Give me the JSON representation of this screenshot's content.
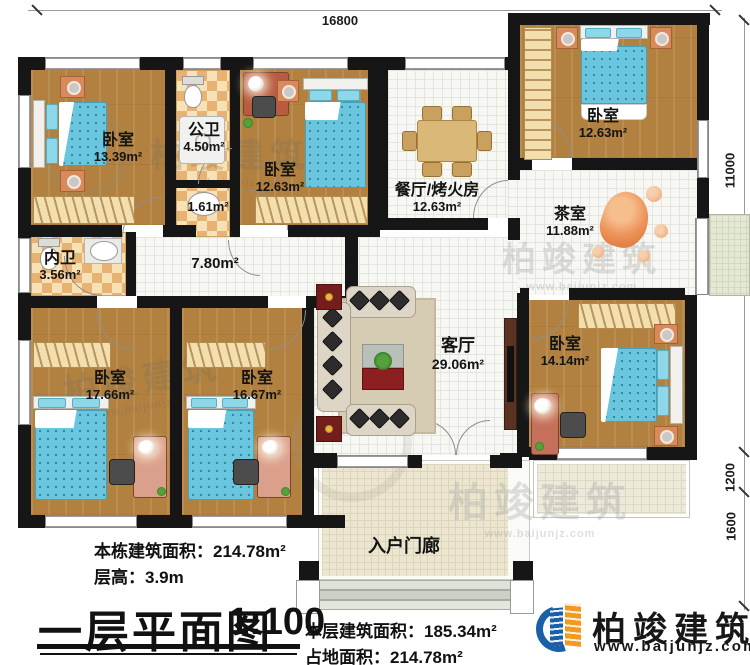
{
  "title_block": {
    "title": "一层平面图",
    "scale": "1:100",
    "building_area_label": "本栋建筑面积：",
    "building_area_value": "214.78m²",
    "floor_height_label": "层高：",
    "floor_height_value": "3.9m",
    "floor_area_label": "本层建筑面积：",
    "floor_area_value": "185.34m²",
    "footprint_label": "占地面积：",
    "footprint_value": "214.78m²"
  },
  "brand": {
    "name": "柏竣建筑",
    "website": "www.baijunjz.com"
  },
  "watermark": {
    "text": "柏竣建筑",
    "website": "www.baijunjz.com"
  },
  "dimensions": {
    "top_width": "16800",
    "right_height": "11000",
    "porch_depth": "1200",
    "steps_depth": "1600"
  },
  "rooms": {
    "bedroom_tl": {
      "name": "卧室",
      "area": "13.39m²"
    },
    "bath_public": {
      "name": "公卫",
      "area": "4.50m²"
    },
    "washroom": {
      "area": "1.61m²"
    },
    "bedroom_tm": {
      "name": "卧室",
      "area": "12.63m²"
    },
    "dining": {
      "name": "餐厅/烤火房",
      "area": "12.63m²"
    },
    "bedroom_tr": {
      "name": "卧室",
      "area": "12.63m²"
    },
    "tea": {
      "name": "茶室",
      "area": "11.88m²"
    },
    "bath_private": {
      "name": "内卫",
      "area": "3.56m²"
    },
    "hallway": {
      "area": "7.80m²"
    },
    "bedroom_bl": {
      "name": "卧室",
      "area": "17.66m²"
    },
    "bedroom_bm": {
      "name": "卧室",
      "area": "16.67m²"
    },
    "living": {
      "name": "客厅",
      "area": "29.06m²"
    },
    "bedroom_br": {
      "name": "卧室",
      "area": "14.14m²"
    },
    "porch": {
      "name": "入户门廊"
    }
  }
}
